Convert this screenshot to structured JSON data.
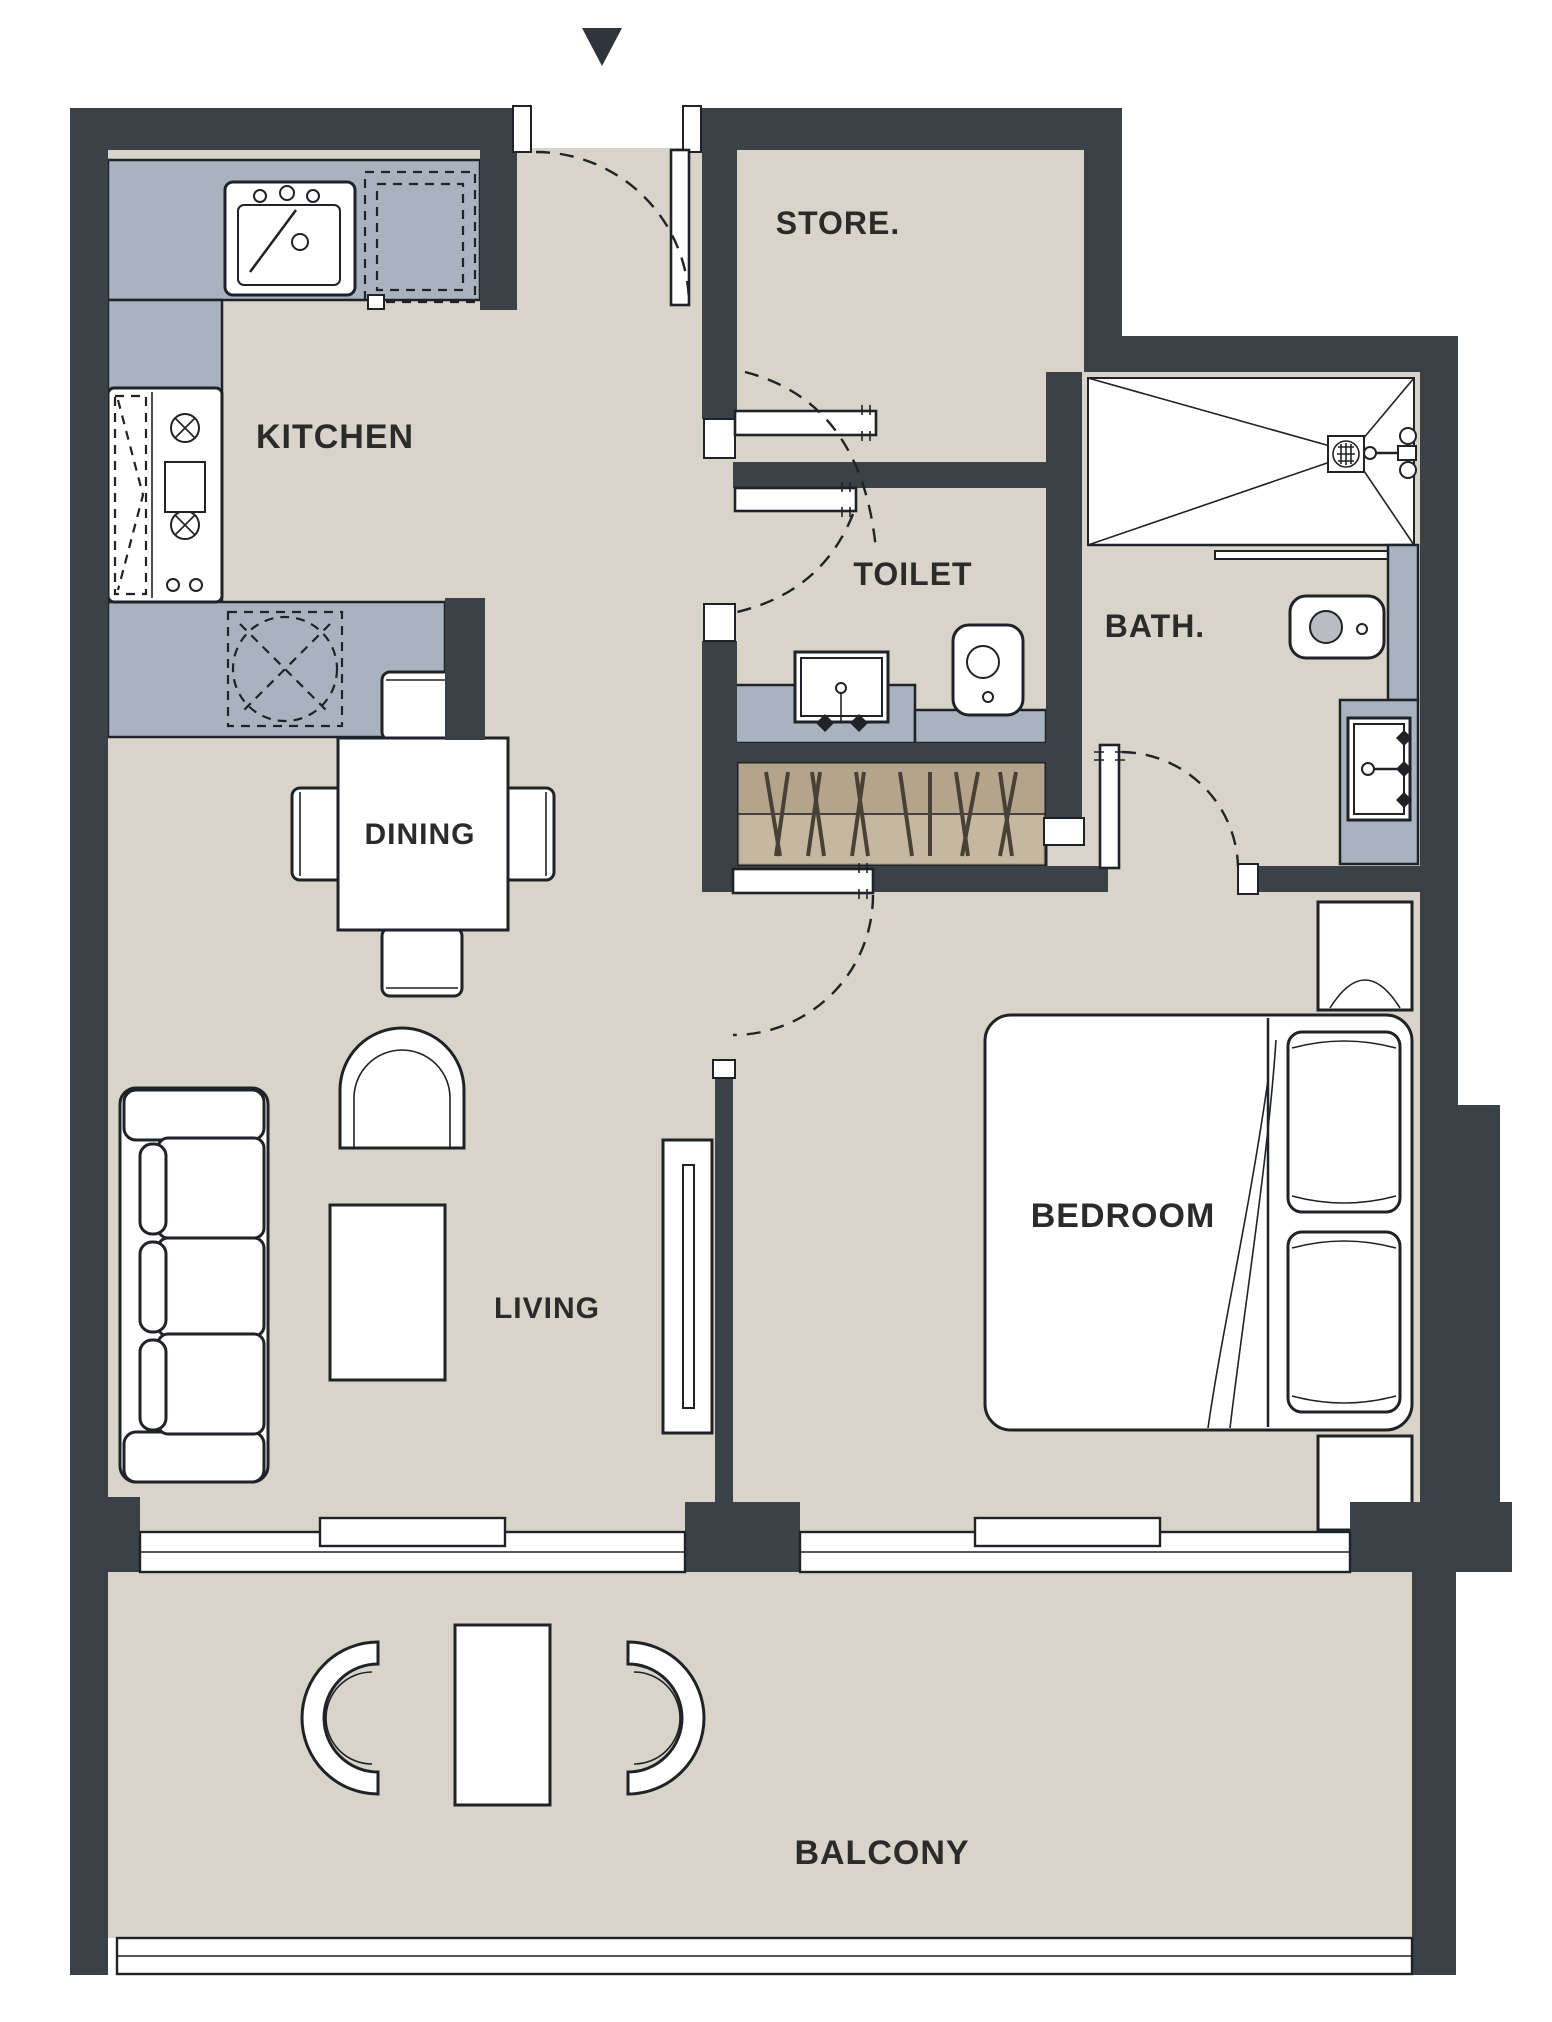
{
  "title": "Apartment floor plan",
  "colors": {
    "wall": "#3A4147",
    "floor": "#D8D4CA",
    "counter": "#A9B2BF",
    "wardrobe": "#B5A48C",
    "wardrobe-light": "#C6B7A0",
    "line": "#1F2226",
    "text": "#2B2B2B"
  },
  "entry_marker": {
    "shape": "triangle-down"
  },
  "rooms": {
    "kitchen": {
      "label": "KITCHEN"
    },
    "store": {
      "label": "STORE."
    },
    "toilet": {
      "label": "TOILET"
    },
    "bath": {
      "label": "BATH."
    },
    "dining": {
      "label": "DINING"
    },
    "living": {
      "label": "LIVING"
    },
    "bedroom": {
      "label": "BEDROOM"
    },
    "balcony": {
      "label": "BALCONY"
    }
  }
}
